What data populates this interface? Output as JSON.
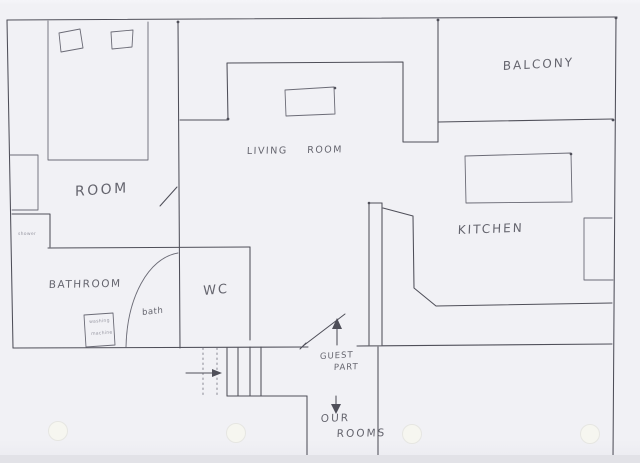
{
  "colors": {
    "paper": "#f1f1f5",
    "paper-edge": "#e2e2e7",
    "ink": "#4f4f59",
    "text": "#55555f",
    "faint": "#8f8f9a",
    "hole": "#f6f6f0"
  },
  "rooms": {
    "balcony": "BALCONY",
    "living_room": "LIVING ROOM",
    "bedroom": "ROOM",
    "kitchen": "KITCHEN",
    "bathroom": "BATHROOM",
    "wc": "WC",
    "bath": "bath",
    "shower": "shower"
  },
  "annotations": {
    "guest_part": [
      "GUEST",
      "PART"
    ],
    "our_rooms": [
      "OUR",
      "ROOMS"
    ],
    "washing_machine": [
      "washing",
      "machine"
    ]
  }
}
